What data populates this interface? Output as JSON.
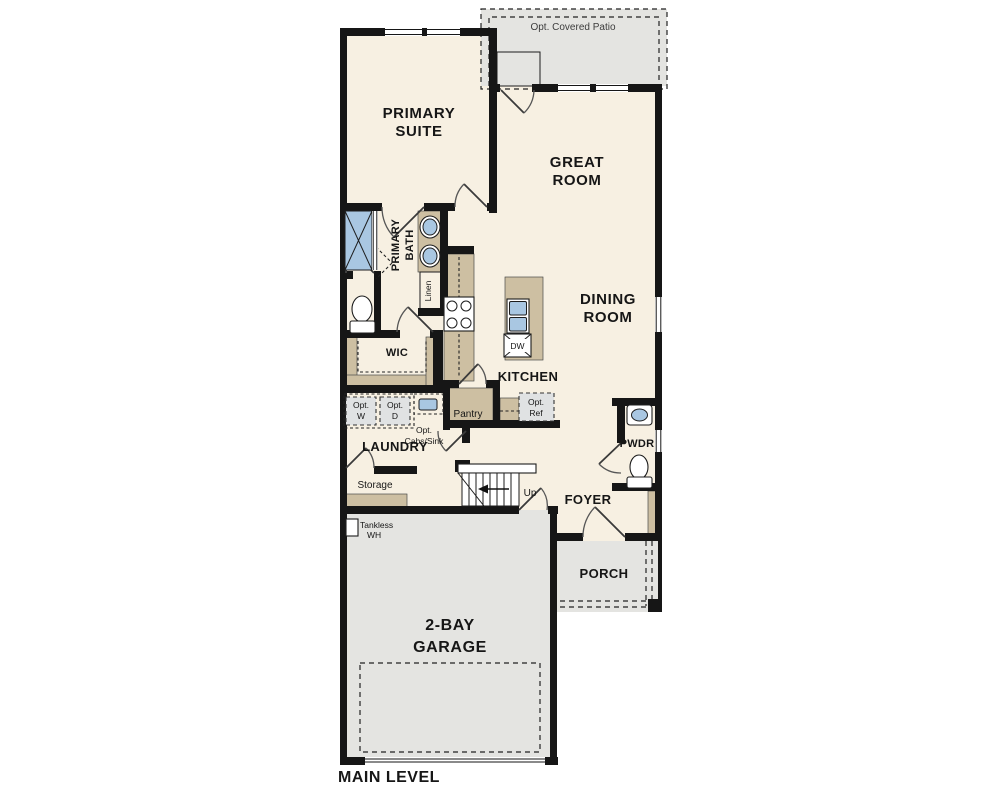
{
  "title": "MAIN LEVEL",
  "rooms": {
    "primary_suite": [
      "PRIMARY",
      "SUITE"
    ],
    "great_room": [
      "GREAT",
      "ROOM"
    ],
    "dining_room": [
      "DINING",
      "ROOM"
    ],
    "primary_bath": [
      "PRIMARY",
      "BATH"
    ],
    "wic": "WIC",
    "linen": "Linen",
    "kitchen": "KITCHEN",
    "pantry": "Pantry",
    "laundry": "LAUNDRY",
    "storage": "Storage",
    "foyer": "FOYER",
    "powder": "PWDR",
    "porch": "PORCH",
    "garage": [
      "2-BAY",
      "GARAGE"
    ],
    "patio": "Opt. Covered Patio"
  },
  "annotations": {
    "up": "Up",
    "dishwasher": "DW",
    "tankless": [
      "Tankless",
      "WH"
    ],
    "opt_washer": [
      "Opt.",
      "W"
    ],
    "opt_dryer": [
      "Opt.",
      "D"
    ],
    "opt_cabs_sink": [
      "Opt.",
      "Cabs/Sink"
    ],
    "opt_ref": [
      "Opt.",
      "Ref"
    ]
  },
  "colors": {
    "floor": "#f7f0e2",
    "hard_surface": "#e4e4e1",
    "casework": "#cdbfa2",
    "fixture_blue": "#a9c7e2",
    "wall": "#161616",
    "appliance_gray": "#e0e2e3"
  }
}
